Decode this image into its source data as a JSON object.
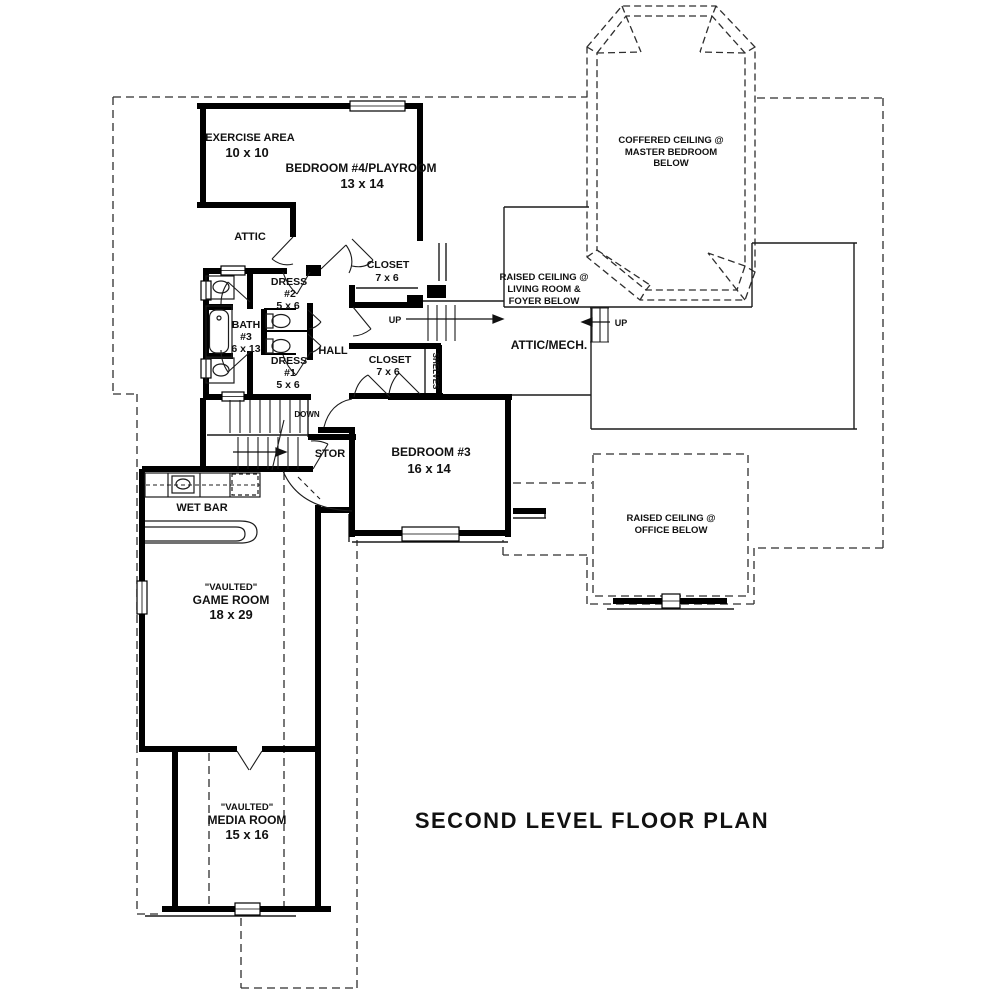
{
  "title": "SECOND LEVEL FLOOR PLAN",
  "labels": {
    "exercise": {
      "name": "EXERCISE AREA",
      "dims": "10 x 10"
    },
    "bedroom4": {
      "name": "BEDROOM #4/PLAYROOM",
      "dims": "13 x 14"
    },
    "attic": "ATTIC",
    "dress2": {
      "l1": "DRESS",
      "l2": "#2",
      "l3": "5 x 6"
    },
    "bath3": {
      "l1": "BATH",
      "l2": "#3",
      "l3": "6 x 13"
    },
    "dress1": {
      "l1": "DRESS",
      "l2": "#1",
      "l3": "5 x 6"
    },
    "hall": "HALL",
    "closet_upper": {
      "name": "CLOSET",
      "dims": "7 x 6"
    },
    "closet_lower": {
      "name": "CLOSET",
      "dims": "7 x 6"
    },
    "shelves": "SHELVES",
    "attic_mech": "ATTIC/MECH.",
    "raised_living": {
      "l1": "RAISED CEILING @",
      "l2": "LIVING ROOM &",
      "l3": "FOYER BELOW"
    },
    "coffered": {
      "l1": "COFFERED CEILING @",
      "l2": "MASTER BEDROOM",
      "l3": "BELOW"
    },
    "raised_office": {
      "l1": "RAISED CEILING @",
      "l2": "OFFICE BELOW"
    },
    "bedroom3": {
      "name": "BEDROOM #3",
      "dims": "16 x 14"
    },
    "stor": "STOR",
    "down": "DOWN",
    "up_hall": "UP",
    "up_attic": "UP",
    "wet_bar": "WET BAR",
    "game_room": {
      "l1": "\"VAULTED\"",
      "l2": "GAME ROOM",
      "l3": "18 x 29"
    },
    "media_room": {
      "l1": "\"VAULTED\"",
      "l2": "MEDIA ROOM",
      "l3": "15 x 16"
    }
  },
  "colors": {
    "wall": "#000000",
    "thin_line": "#1c1c1c",
    "dashed_line": "#2e2e2e",
    "background": "#ffffff",
    "text": "#111111"
  }
}
